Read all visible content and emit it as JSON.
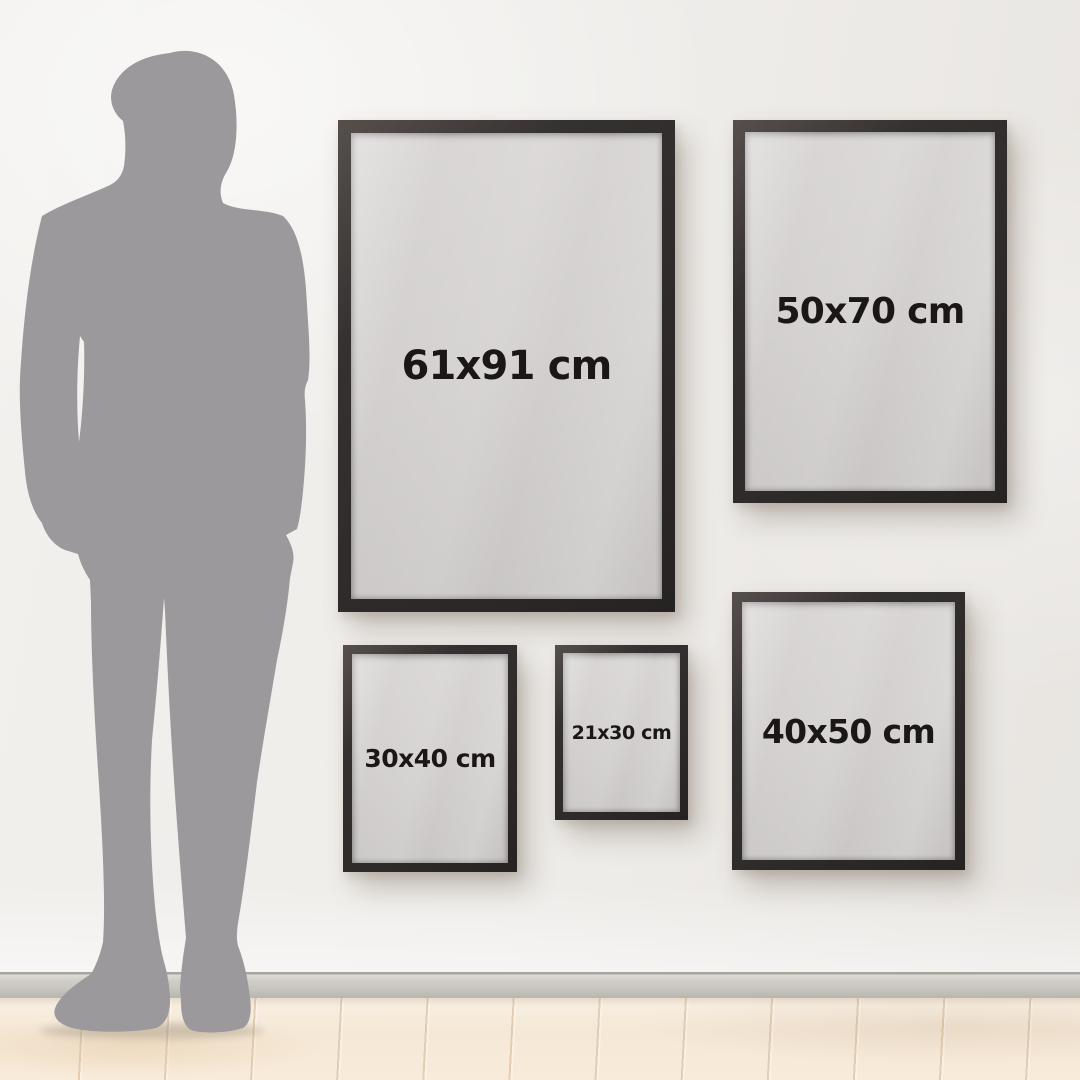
{
  "figure": {
    "alt": "Standing man silhouette shown for scale",
    "color": "#9b999b"
  },
  "frames": [
    {
      "name": "61x91",
      "label": "61x91 cm",
      "width_cm": 61,
      "height_cm": 91
    },
    {
      "name": "50x70",
      "label": "50x70 cm",
      "width_cm": 50,
      "height_cm": 70
    },
    {
      "name": "30x40",
      "label": "30x40 cm",
      "width_cm": 30,
      "height_cm": 40
    },
    {
      "name": "21x30",
      "label": "21x30 cm",
      "width_cm": 21,
      "height_cm": 30
    },
    {
      "name": "40x50",
      "label": "40x50 cm",
      "width_cm": 40,
      "height_cm": 50
    }
  ],
  "colors": {
    "wall": "#efece9",
    "frame": "#2f2b2a",
    "poster": "#d3d0cf",
    "label_text": "#1a1716",
    "baseboard": "#c9c6c0",
    "floor_wood": "#f5e8d6",
    "silhouette": "#9b999b"
  }
}
